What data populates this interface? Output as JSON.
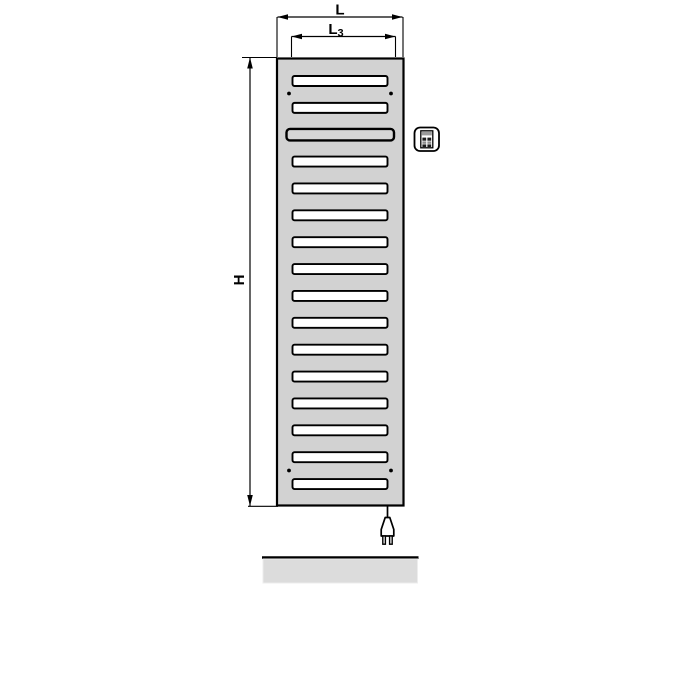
{
  "diagram": {
    "kind": "electric-radiator-front-view-technical-drawing",
    "dimension_labels": {
      "overall_width": "L",
      "inner_width_main": "L",
      "inner_width_sub": "3",
      "height": "H"
    },
    "radiator": {
      "slot_count": 16,
      "wide_slot_position": 3,
      "mounting_hole_rows": 2,
      "mounting_holes_per_row": 2
    },
    "colors": {
      "body": "#d2d2d2",
      "slot": "#ffffff",
      "wide_slot": "#d6d6d6",
      "outline": "#000000",
      "floor": "#dcdcdc",
      "background": "#ffffff"
    },
    "icons": {
      "control_unit": "control-unit-icon",
      "power_plug": "power-plug-icon"
    }
  }
}
